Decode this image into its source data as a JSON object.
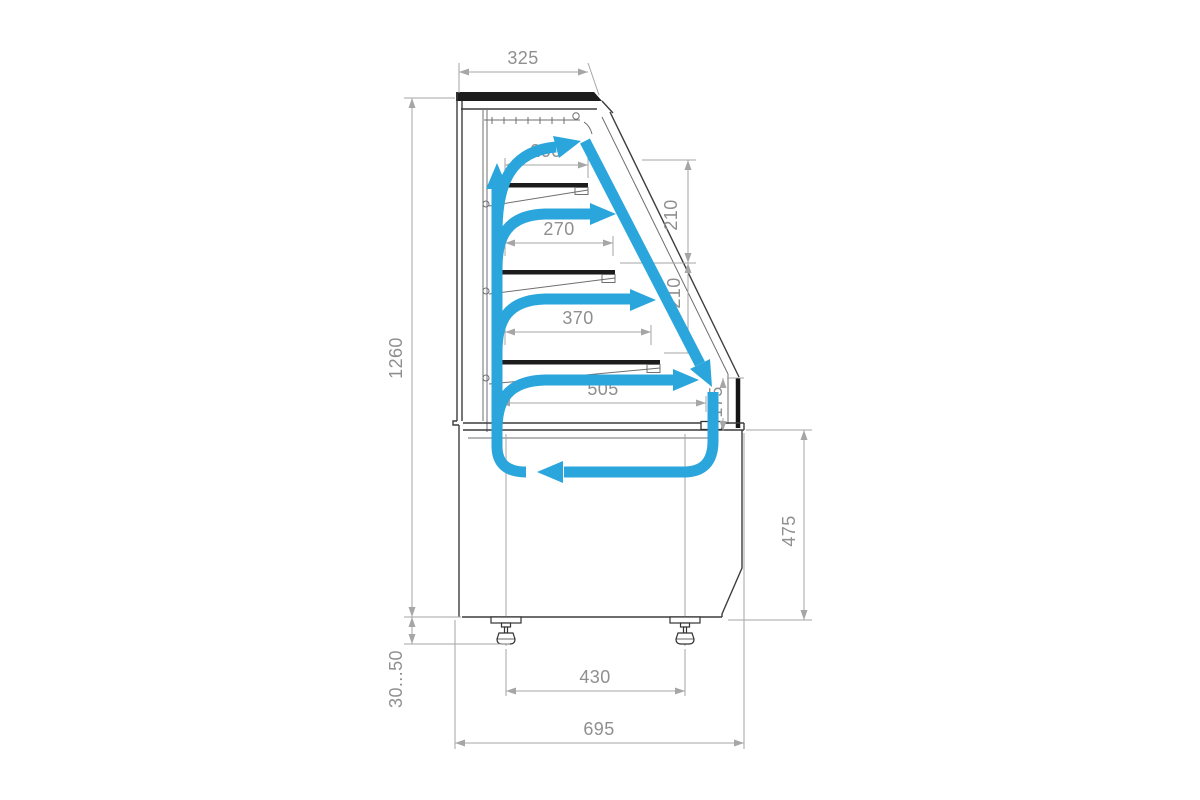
{
  "colors": {
    "accent": "#2ba6dc",
    "line": "#3d3d3d",
    "dimline": "#a6a6a6",
    "dimtext": "#8f8f8f",
    "dark": "#1c1c1c"
  },
  "drawing": {
    "type": "refrigerated pastry display case - side section with airflow",
    "units": "mm"
  },
  "dimensions": {
    "top_depth": "325",
    "shelf_1_depth": "200",
    "shelf_2_depth": "270",
    "shelf_3_depth": "370",
    "deck_depth": "505",
    "shelf_gap_1": "210",
    "shelf_gap_2": "210",
    "deck_gap": "175",
    "overall_height": "1260",
    "leg_adjust_range": "30...50",
    "base_height": "475",
    "leg_spacing": "430",
    "overall_depth": "695"
  }
}
